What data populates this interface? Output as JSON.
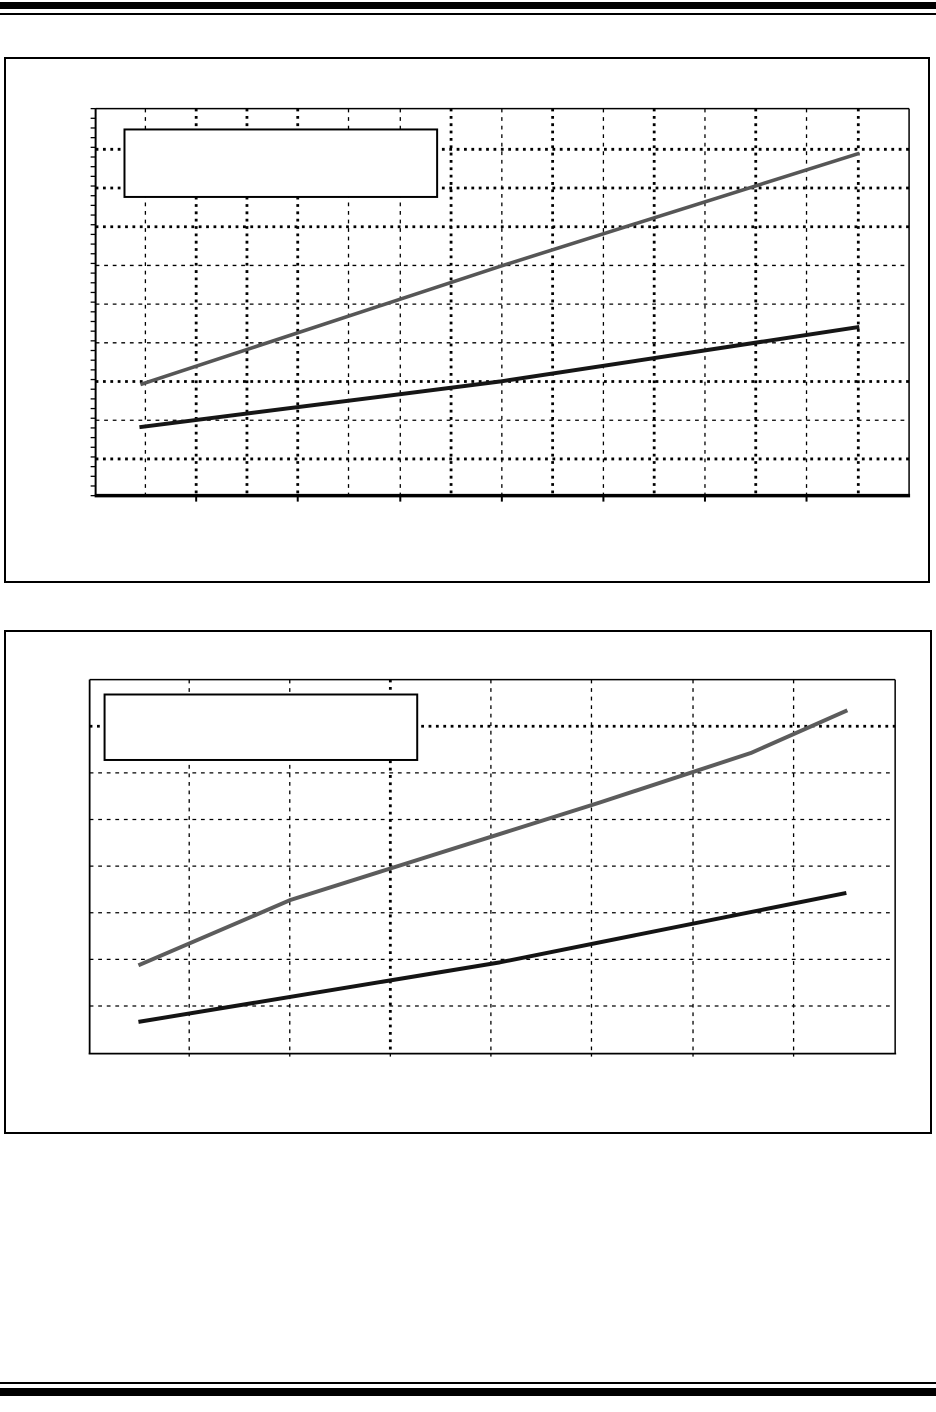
{
  "page": {
    "background": "#ffffff",
    "rule_color": "#000000",
    "visible_text": "",
    "notes_colors": {
      "grid_color": "#000000",
      "series_gray": "#565656",
      "series_black": "#161616"
    }
  },
  "charts": [
    {
      "name": "figure-1",
      "frame": {
        "x": 4,
        "y": 57,
        "w": 926,
        "h": 526
      },
      "plot": {
        "x": 94,
        "y": 107,
        "w": 817,
        "h": 390
      },
      "spines": {
        "top": 1.5,
        "right": 1.5,
        "left": 2,
        "bottom": 3.5
      },
      "left_minor_ticks": {
        "step": 9.75,
        "len": 5,
        "width": 1.3
      },
      "bottom_ticks": {
        "xs": [
          195,
          297,
          400,
          502,
          604,
          706,
          808
        ],
        "len": 6,
        "width": 2
      },
      "grid": {
        "v": [
          {
            "x": 144,
            "w": "light"
          },
          {
            "x": 195,
            "w": "heavy"
          },
          {
            "x": 246,
            "w": "heavy"
          },
          {
            "x": 297,
            "w": "heavy"
          },
          {
            "x": 348,
            "w": "light"
          },
          {
            "x": 400,
            "w": "light"
          },
          {
            "x": 451,
            "w": "heavy"
          },
          {
            "x": 502,
            "w": "light"
          },
          {
            "x": 553,
            "w": "heavy"
          },
          {
            "x": 604,
            "w": "light"
          },
          {
            "x": 655,
            "w": "heavy"
          },
          {
            "x": 706,
            "w": "light"
          },
          {
            "x": 757,
            "w": "heavy"
          },
          {
            "x": 808,
            "w": "light"
          },
          {
            "x": 860,
            "w": "heavy"
          }
        ],
        "h": [
          {
            "y": 148,
            "w": "heavy"
          },
          {
            "y": 187,
            "w": "heavy"
          },
          {
            "y": 226,
            "w": "heavy"
          },
          {
            "y": 265,
            "w": "light"
          },
          {
            "y": 304,
            "w": "light"
          },
          {
            "y": 343,
            "w": "light"
          },
          {
            "y": 382,
            "w": "heavy"
          },
          {
            "y": 421,
            "w": "light"
          },
          {
            "y": 460,
            "w": "heavy"
          }
        ]
      },
      "legend_box": {
        "x": 123,
        "y": 128,
        "w": 314,
        "h": 68,
        "border": 2,
        "fill": "#ffffff",
        "text": ""
      },
      "series": [
        {
          "name": "upper-gray-line",
          "color": "#565656",
          "width": 3.6,
          "points": [
            [
              139,
              385
            ],
            [
              500,
              266
            ],
            [
              861,
              152
            ]
          ]
        },
        {
          "name": "lower-black-line",
          "color": "#161616",
          "width": 4,
          "points": [
            [
              138,
              428
            ],
            [
              500,
              382
            ],
            [
              861,
              327
            ]
          ]
        }
      ]
    },
    {
      "name": "figure-2",
      "frame": {
        "x": 4,
        "y": 630,
        "w": 928,
        "h": 504
      },
      "plot": {
        "x": 88,
        "y": 678,
        "w": 809,
        "h": 377
      },
      "spines": {
        "top": 1.5,
        "right": 1.5,
        "left": 1.8,
        "bottom": 1.8
      },
      "left_minor_ticks": null,
      "bottom_ticks": {
        "xs": [
          188,
          289,
          390,
          491,
          592,
          694,
          795
        ],
        "len": 3,
        "width": 1.3
      },
      "grid": {
        "v": [
          {
            "x": 188,
            "w": "light"
          },
          {
            "x": 289,
            "w": "light"
          },
          {
            "x": 390,
            "w": "heavy"
          },
          {
            "x": 491,
            "w": "light"
          },
          {
            "x": 592,
            "w": "light"
          },
          {
            "x": 694,
            "w": "light"
          },
          {
            "x": 795,
            "w": "light"
          }
        ],
        "h": [
          {
            "y": 725,
            "w": "heavy"
          },
          {
            "y": 772,
            "w": "light"
          },
          {
            "y": 819,
            "w": "light"
          },
          {
            "y": 866,
            "w": "light"
          },
          {
            "y": 913,
            "w": "light"
          },
          {
            "y": 960,
            "w": "light"
          },
          {
            "y": 1007,
            "w": "light"
          }
        ]
      },
      "legend_box": {
        "x": 103,
        "y": 693,
        "w": 314,
        "h": 66,
        "border": 2,
        "fill": "#ffffff",
        "text": ""
      },
      "series": [
        {
          "name": "upper-gray-line",
          "color": "#5c5c5c",
          "width": 4,
          "points": [
            [
              137,
              966
            ],
            [
              290,
              900
            ],
            [
              600,
              802
            ],
            [
              752,
              752
            ],
            [
              849,
              709
            ]
          ]
        },
        {
          "name": "lower-black-line",
          "color": "#141414",
          "width": 4,
          "points": [
            [
              137,
              1023
            ],
            [
              500,
              963
            ],
            [
              848,
              893
            ]
          ]
        }
      ]
    }
  ],
  "chart_data": [
    {
      "type": "line",
      "title": "",
      "xlabel": "",
      "ylabel": "",
      "tick_labels_visible": false,
      "legend": {
        "present": true,
        "entries_visible": false
      },
      "grid": {
        "on": true,
        "x_divisions": 16,
        "y_divisions": 10
      },
      "series": [
        {
          "name": "upper-gray-line",
          "color": "#565656",
          "points_grid_units": [
            [
              0.88,
              2.87
            ],
            [
              7.95,
              5.92
            ],
            [
              15.01,
              8.85
            ]
          ]
        },
        {
          "name": "lower-black-line",
          "color": "#161616",
          "points_grid_units": [
            [
              0.86,
              1.77
            ],
            [
              7.95,
              2.95
            ],
            [
              15.01,
              4.36
            ]
          ]
        }
      ]
    },
    {
      "type": "line",
      "title": "",
      "xlabel": "",
      "ylabel": "",
      "tick_labels_visible": false,
      "legend": {
        "present": true,
        "entries_visible": false
      },
      "grid": {
        "on": true,
        "x_divisions": 8,
        "y_divisions": 8
      },
      "series": [
        {
          "name": "upper-gray-line",
          "color": "#5c5c5c",
          "points_grid_units": [
            [
              0.48,
              1.89
            ],
            [
              2.0,
              3.29
            ],
            [
              5.06,
              5.37
            ],
            [
              6.57,
              6.43
            ],
            [
              7.53,
              7.35
            ]
          ]
        },
        {
          "name": "lower-black-line",
          "color": "#141414",
          "points_grid_units": [
            [
              0.48,
              0.68
            ],
            [
              4.08,
              1.95
            ],
            [
              7.52,
              3.44
            ]
          ]
        }
      ]
    }
  ]
}
